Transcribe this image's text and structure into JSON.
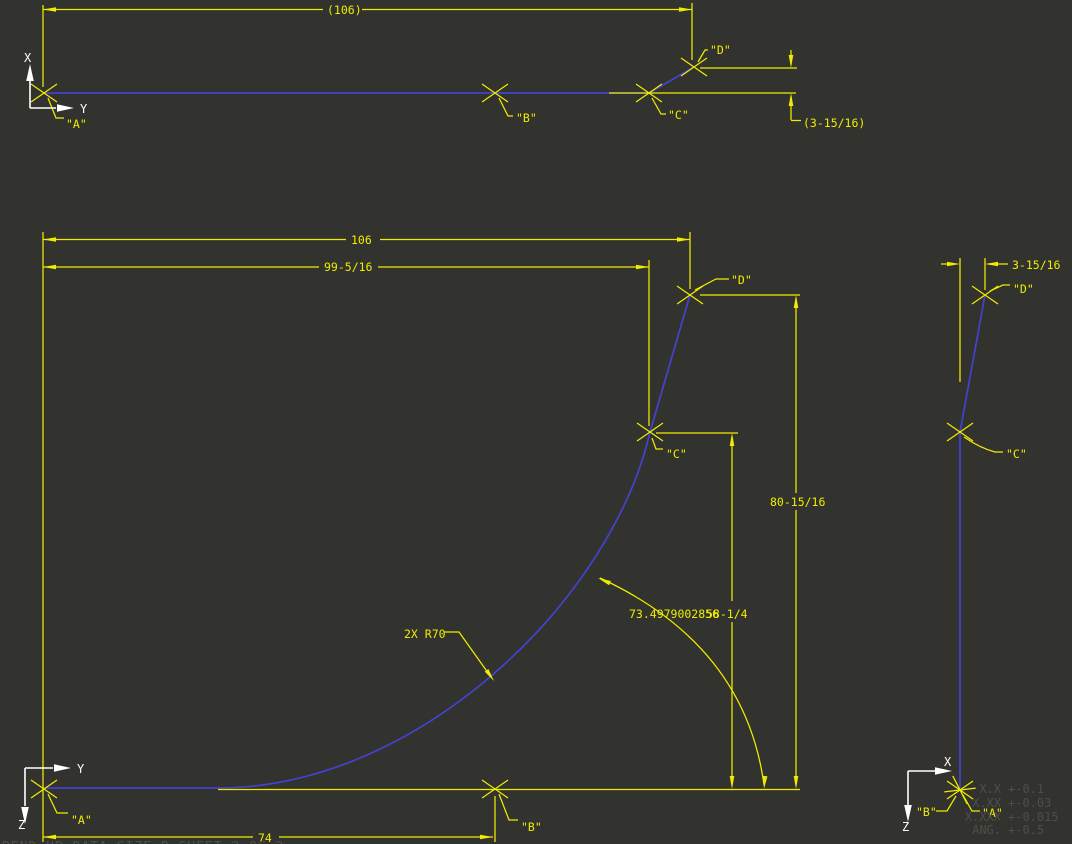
{
  "drawing": {
    "footer": "BEND UP DATA    SIZE  B    SHEET 2 OF 2",
    "colors": {
      "background": "#32322e",
      "dimension_yellow": "#efec00",
      "geometry_blue": "#4343d0",
      "axes_white": "#ffffff",
      "tolerance_gray": "#4e4e4a"
    },
    "top_view": {
      "dim_overall": "(106)",
      "dim_offset": "(3-15/16)",
      "point_a": "\"A\"",
      "point_b": "\"B\"",
      "point_c": "\"C\"",
      "point_d": "\"D\"",
      "axis_x": "X",
      "axis_y": "Y"
    },
    "front_view": {
      "dim_overall": "106",
      "dim_to_c": "99-5/16",
      "dim_bottom": "74",
      "dim_height_d": "80-15/16",
      "dim_height_c": "58-1/4",
      "dim_arc_length": "73.4979002856",
      "dim_radius": "2X R70",
      "point_a": "\"A\"",
      "point_b": "\"B\"",
      "point_c": "\"C\"",
      "point_d": "\"D\"",
      "axis_y": "Y",
      "axis_z": "Z"
    },
    "side_view": {
      "dim_offset": "3-15/16",
      "point_a": "\"A\"",
      "point_b": "\"B\"",
      "point_c": "\"C\"",
      "point_d": "\"D\"",
      "axis_x": "X",
      "axis_z": "Z",
      "tolerances": [
        {
          "label": "X.X",
          "value": "+-0.1"
        },
        {
          "label": "X.XX",
          "value": "+-0.03"
        },
        {
          "label": "X.XXX",
          "value": "+-0.015"
        },
        {
          "label": "ANG.",
          "value": "+-0.5"
        }
      ]
    }
  }
}
